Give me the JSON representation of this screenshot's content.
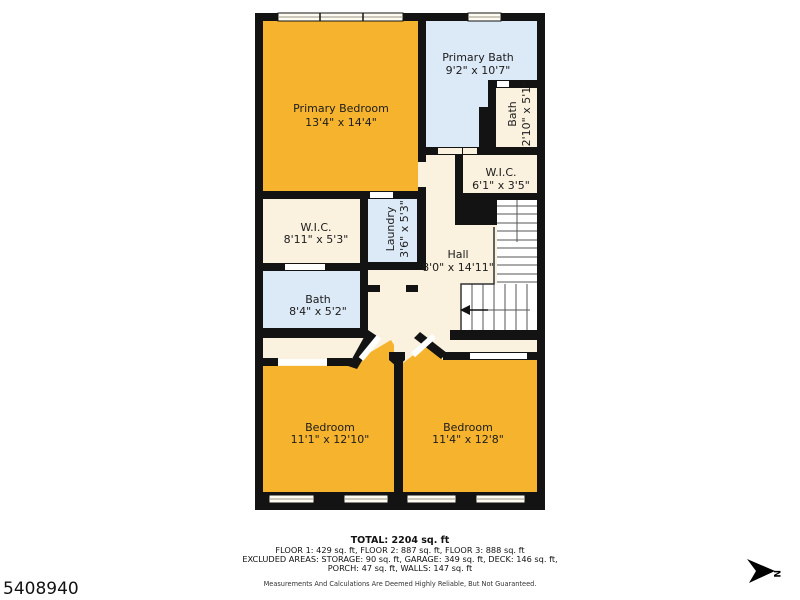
{
  "plan": {
    "rooms": [
      {
        "id": "primary-bedroom",
        "name": "Primary Bedroom",
        "dims": "13'4\" x 14'4\""
      },
      {
        "id": "primary-bath",
        "name": "Primary Bath",
        "dims": "9'2\" x 10'7\""
      },
      {
        "id": "bath-upper",
        "name": "Bath",
        "dims": "2'10\" x 5'1\""
      },
      {
        "id": "wic-small",
        "name": "W.I.C.",
        "dims": "6'1\" x 3'5\""
      },
      {
        "id": "wic-large",
        "name": "W.I.C.",
        "dims": "8'11\" x 5'3\""
      },
      {
        "id": "laundry",
        "name": "Laundry",
        "dims": "3'6\" x 5'3\""
      },
      {
        "id": "hall",
        "name": "Hall",
        "dims": "8'0\" x 14'11\""
      },
      {
        "id": "bath-lower",
        "name": "Bath",
        "dims": "8'4\" x 5'2\""
      },
      {
        "id": "bedroom-left",
        "name": "Bedroom",
        "dims": "11'1\" x 12'10\""
      },
      {
        "id": "bedroom-right",
        "name": "Bedroom",
        "dims": "11'4\" x 12'8\""
      }
    ],
    "colors": {
      "warm_room": "#F6B42E",
      "cool_room": "#DCE9F7",
      "neutral_room": "#FAF1DE",
      "wall": "#131313",
      "background": "#FFFFFF"
    }
  },
  "footer": {
    "total": "TOTAL: 2204 sq. ft",
    "floors": "FLOOR 1: 429 sq. ft, FLOOR 2: 887 sq. ft, FLOOR 3: 888 sq. ft",
    "excluded_line1": "EXCLUDED AREAS: STORAGE: 90 sq. ft, GARAGE: 349 sq. ft, DECK: 146 sq. ft,",
    "excluded_line2": "PORCH: 47 sq. ft, WALLS: 147 sq. ft",
    "disclaimer": "Measurements And Calculations Are Deemed Highly Reliable, But Not Guaranteed."
  },
  "listing_id": "5408940",
  "compass": {
    "label": "N"
  }
}
